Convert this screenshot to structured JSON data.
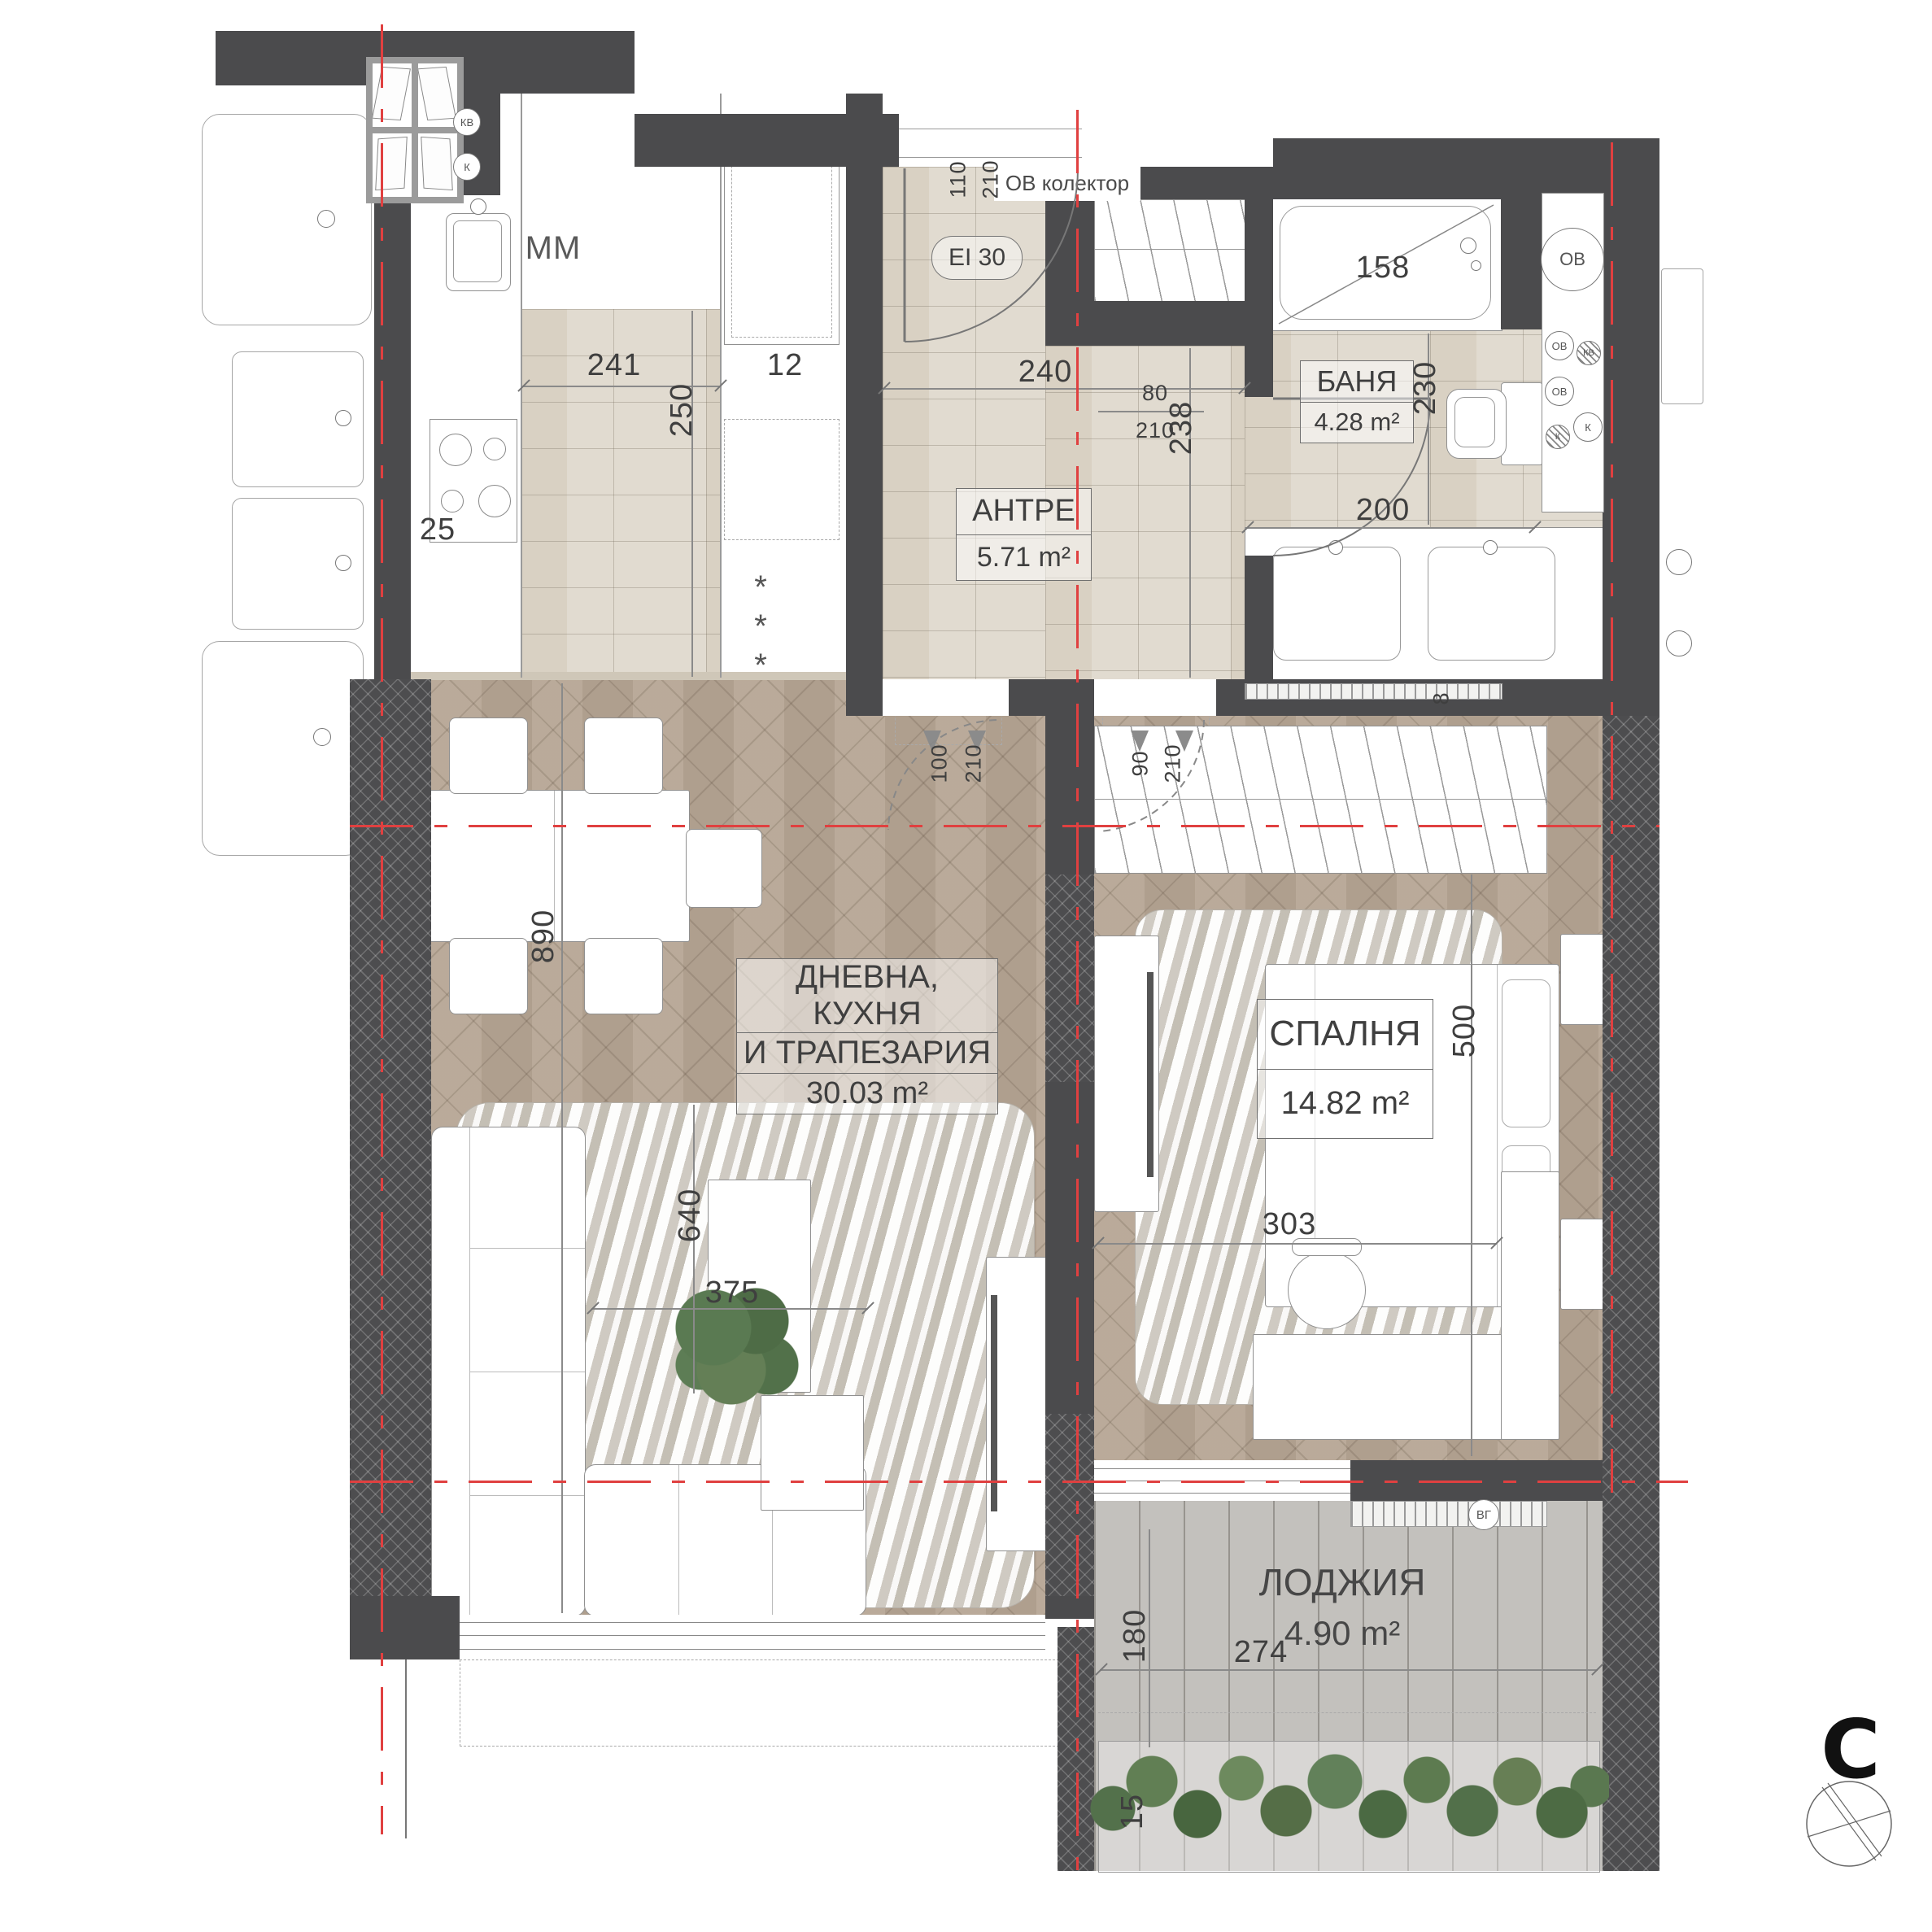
{
  "rooms": {
    "entry": {
      "name": "АНТРЕ",
      "area": "5.71 m²"
    },
    "bath": {
      "name": "БАНЯ",
      "area": "4.28 m²"
    },
    "living": {
      "name_line1": "ДНЕВНА, КУХНЯ",
      "name_line2": "И ТРАПЕЗАРИЯ",
      "area": "30.03 m²"
    },
    "bedroom": {
      "name": "СПАЛНЯ",
      "area": "14.82 m²"
    },
    "loggia": {
      "name": "ЛОДЖИЯ",
      "area": "4.90 m²"
    }
  },
  "dims": {
    "d241": "241",
    "d250": "250",
    "d12": "12",
    "d25": "25",
    "d240": "240",
    "d238": "238",
    "d230": "230",
    "d200": "200",
    "d158": "158",
    "d8": "8",
    "d890": "890",
    "d640": "640",
    "d375": "375",
    "d500": "500",
    "d303": "303",
    "d180": "180",
    "d274": "274",
    "d15": "15",
    "door_entry_w": "110",
    "door_entry_h": "210",
    "door_bath_w": "80",
    "door_bath_h": "210",
    "door_living_w": "100",
    "door_living_h": "210",
    "door_bedroom_w": "90",
    "door_bedroom_h": "210"
  },
  "shaft": {
    "s1": "ОВ",
    "s2": "ОВ",
    "s3": "КВ",
    "s4": "ОВ",
    "s5": "К",
    "s6": "К"
  },
  "window_symbols": {
    "w1": "КВ",
    "w2": "К"
  },
  "misc": {
    "kitchen_mm": "ММ",
    "fire_rating": "EI 30",
    "collector": "ОВ колектор",
    "fridge_stars": "***",
    "vg": "ВГ",
    "north": "С"
  },
  "colors": {
    "wall": "#4b4b4d",
    "tile": "#d9d1c3",
    "wood": "#b6a695",
    "deck": "#c3c1bd",
    "section_line": "#e04040",
    "plant": "#5a7a52"
  }
}
